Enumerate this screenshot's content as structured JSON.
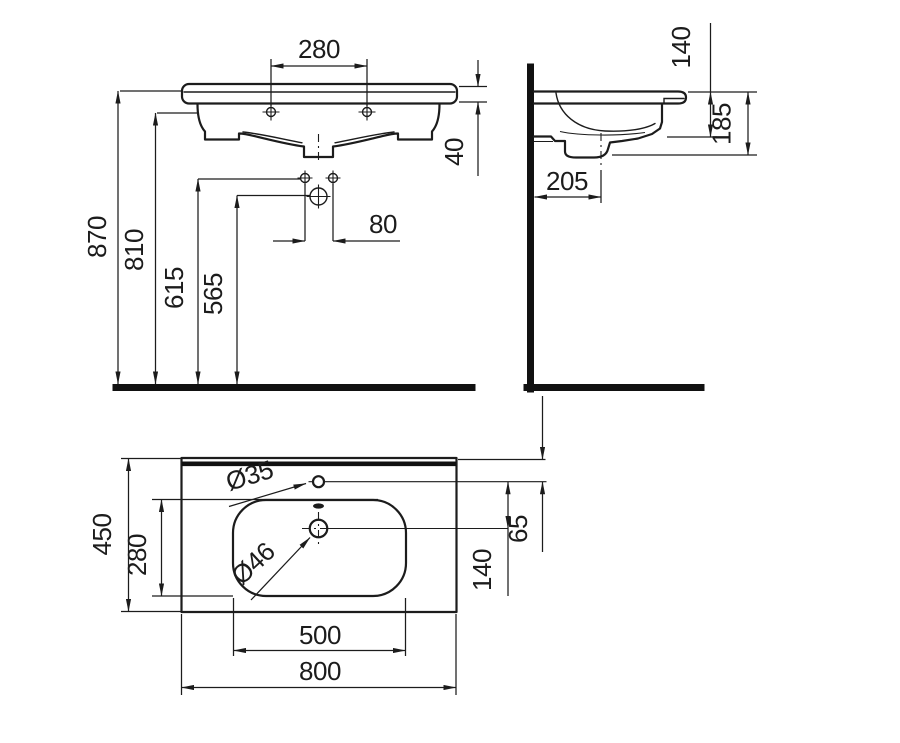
{
  "drawing": {
    "type": "washbasin-installation-dimension-drawing",
    "units": "mm",
    "colors": {
      "line": "#1c1c1c",
      "heavy_line": "#111111",
      "background": "#ffffff"
    }
  },
  "front_view": {
    "fixing_hole_spacing": "280",
    "rim_thickness": "40",
    "bracket_hole_spacing": "80",
    "floor_to_rim": "870",
    "floor_to_basin_bottom": "810",
    "floor_to_bracket_upper": "615",
    "floor_to_bracket_lower": "565"
  },
  "side_view": {
    "rim_to_underside": "140",
    "rim_to_trap_bottom": "185",
    "wall_to_drain": "205"
  },
  "plan_view": {
    "overall_width": "800",
    "overall_depth": "450",
    "bowl_width": "500",
    "bowl_depth": "280",
    "tap_hole_diameter": "Ø35",
    "drain_diameter": "Ø46",
    "back_edge_to_tap_hole": "65",
    "tap_hole_to_drain": "140"
  }
}
